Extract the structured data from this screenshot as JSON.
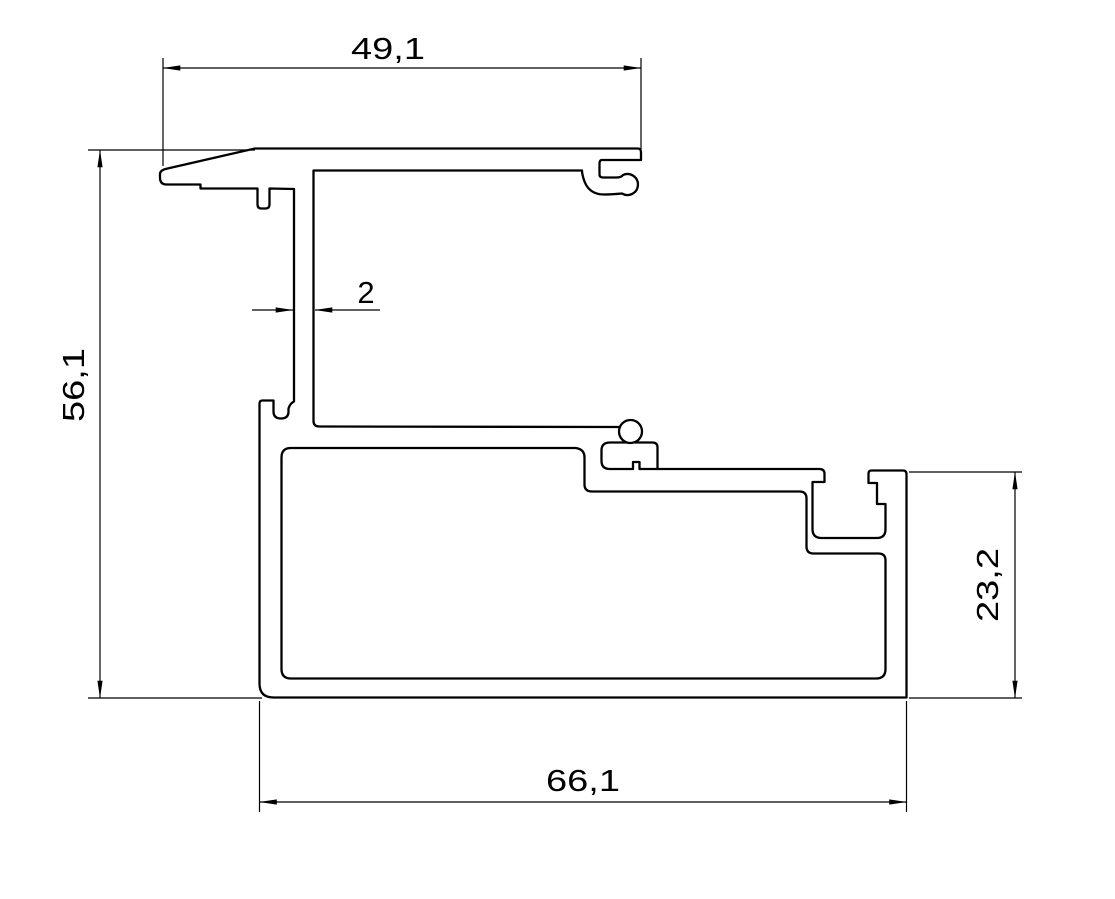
{
  "meta": {
    "type": "technical-drawing",
    "description": "2D CAD cross-section drawing of an aluminium window frame profile with linear dimensions",
    "background_color": "#ffffff",
    "line_color": "#000000",
    "decimal_style": "comma"
  },
  "dimensions": [
    {
      "id": "top-width",
      "label": "49,1",
      "value": 49.1,
      "orientation": "horizontal",
      "location": "top"
    },
    {
      "id": "left-height",
      "label": "56,1",
      "value": 56.1,
      "orientation": "vertical",
      "location": "left"
    },
    {
      "id": "wall-thickness",
      "label": "2",
      "value": 2,
      "orientation": "horizontal",
      "location": "middle-left"
    },
    {
      "id": "right-height",
      "label": "23,2",
      "value": 23.2,
      "orientation": "vertical",
      "location": "right"
    },
    {
      "id": "bottom-width",
      "label": "66,1",
      "value": 66.1,
      "orientation": "horizontal",
      "location": "bottom"
    }
  ],
  "drawing": {
    "outer_contour": "M 160,177.5 L 160,174 Q 160,170 167.5,168.5 L 255,148.5 L 637.5,148.5 Q 641,148.5 641,152 L 641,160 L 601.5,160 Q 599.5,160.5 599.5,163.5 L 599.5,174.5 Q 599.5,177.5 603,177.5 L 616,177.5 Q 621.5,177.5 623,175 A 10.5,10.5 0 1 1 622,193.5 Q 611,194.5 604,194.5 Q 589.5,194.5 584.5,181.5 Q 582,174.5 582,170.5 L 313.5,170.5 L 313.5,421 Q 313.5,426.5 319.5,426.5 L 620,427 M 626,442.5 L 610,442.5 Q 601.5,442.5 601.5,450.5 L 601.5,461 Q 601.5,469 610,469 L 633,469 L 633,462 L 639.5,462 L 639.5,469 L 819.5,469 Q 824.5,469 824.5,474 L 824.5,482 L 812.5,482 L 812.5,529 Q 812.5,538 821.5,538 L 877,538 Q 885.5,538 885.5,529 L 885.5,504 L 877,504 L 877,483 L 868.5,483 L 868.5,473.5 Q 868.5,470.5 871.5,470.5 L 903,470.5 Q 906.5,470.5 906.5,474 L 906.5,697.5 L 273.5,697.5 Q 259.5,697.5 259.5,683.5 L 259.5,403.5 Q 259.5,400.5 262.5,400.5 L 273.5,400.5 L 273.5,411.5 Q 273.5,418.5 281,418.5 Q 288.5,418.5 288.5,411.5 L 288.5,408.5 Q 290,403.5 294,401.5 L 294,189 L 269.5,188.5 L 269.5,204.5 Q 269.5,208.5 265.5,208.5 L 261.5,208.5 Q 257.5,208.5 257.5,204.5 L 257.5,188.5 L 200.5,188.5 L 200.5,184.5 L 166.5,184.5 Q 160,184.5 160,177.5",
    "glazing_bead_knob": "M 619,431.5 A 11.5,11.5 0 1 0 642,431.5 A 11.5,11.5 0 1 0 619,431.5",
    "bead_groove_ceiling": "M 635,442.5 L 652.5,442.5 Q 657.5,442.5 657.5,447.5 L 657.5,469",
    "inner_cavity": "M 291,448 L 575.5,448 Q 584.5,449 584.5,457.5 L 584.5,484.5 Q 584.5,491.5 592,491.5 L 799.5,491.5 Q 806.5,491.5 806.5,498.5 L 806.5,546.5 Q 806.5,553.5 813.5,553.5 L 878.5,553.5 Q 885.5,553.5 885.5,560.5 L 885.5,669 Q 885.5,678.5 876,678.5 L 291,678.5 Q 281.5,678.5 281.5,669 L 281.5,457.5 Q 281.5,448 291,448 Z"
  }
}
